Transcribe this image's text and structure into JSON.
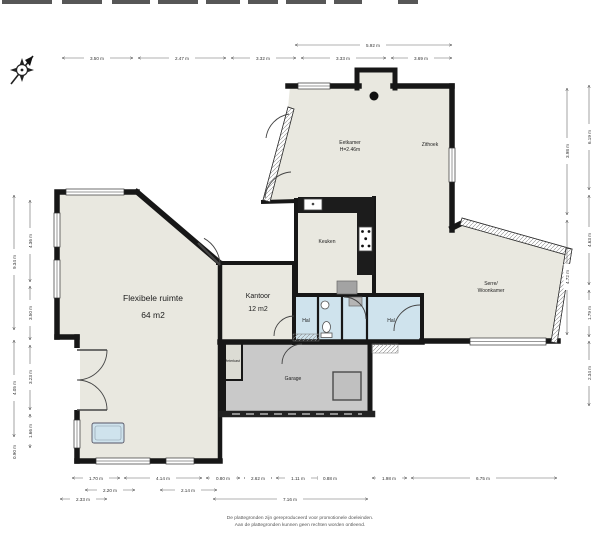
{
  "rooms": {
    "flexibele": {
      "name": "Flexibele ruimte",
      "area": "64 m2"
    },
    "kantoor": {
      "name": "Kantoor",
      "area": "12 m2"
    },
    "eetkamer": {
      "name": "Eetkamer",
      "height": "H=2.46m"
    },
    "zithoek": {
      "name": "Zithoek"
    },
    "keuken": {
      "name": "Keuken"
    },
    "serre": {
      "line1": "Serre/",
      "line2": "Woonkamer"
    },
    "hal_left": {
      "name": "Hal"
    },
    "hal_right": {
      "name": "Hal"
    },
    "garage": {
      "name": "Garage"
    },
    "meterkast": {
      "name": "Meterkast"
    }
  },
  "dimensions": {
    "top_span": "5.92 m",
    "top": [
      "3.50 m",
      "2.47 m",
      "3.32 m",
      "3.33 m",
      "3.69 m"
    ],
    "left_outer": [
      "9.34 m",
      "4.05 m",
      "0.90 m"
    ],
    "left_inner": [
      "4.36 m",
      "3.50 m",
      "3.23 m",
      "1.66 m"
    ],
    "right_inner": [
      "3.98 m",
      "4.72 m"
    ],
    "right_outer": [
      "6.19 m",
      "4.63 m",
      "1.79 m",
      "2.34 m"
    ],
    "bottom_row1": [
      "1.70 m",
      "4.14 m",
      "0.80 m",
      "2.62 m",
      "1.11 m",
      "0.88 m",
      "1.98 m",
      "6.75 m"
    ],
    "bottom_row2": [
      "2.20 m",
      "2.14 m"
    ],
    "bottom_row3": [
      "2.33 m",
      "7.16 m"
    ]
  },
  "footer": {
    "line1": "De plattegronden zijn gereproduceerd voor promotionele doeleinden.",
    "line2": "Aan de plattegronden kunnen geen rechten worden ontleend."
  },
  "colors": {
    "wall": "#171717",
    "floor": "#e9e8e0",
    "hal_floor": "#cfe3ed",
    "garage_floor": "#c9c9c9",
    "fixture_gray": "#a3a3a3"
  }
}
